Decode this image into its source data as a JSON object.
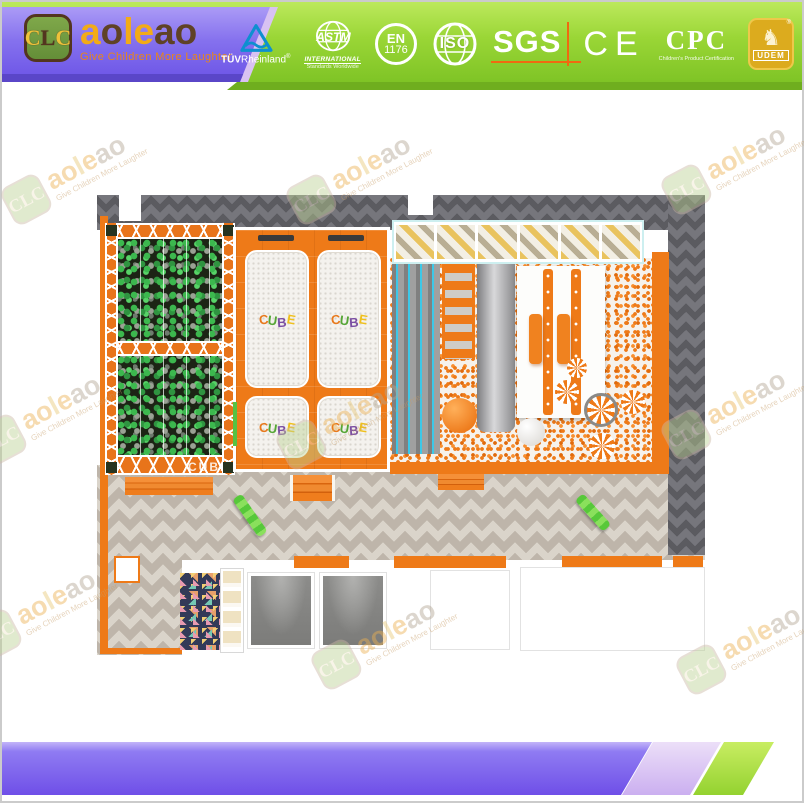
{
  "header": {
    "badge_letters": {
      "left": "C",
      "mid": "L",
      "right": "C"
    },
    "brand": "aoleao",
    "brand_letters": [
      {
        "ch": "a",
        "color": "#f2ab18"
      },
      {
        "ch": "o",
        "color": "#5f4226"
      },
      {
        "ch": "l",
        "color": "#f2ab18"
      },
      {
        "ch": "e",
        "color": "#f2ab18"
      },
      {
        "ch": "a",
        "color": "#5f4226"
      },
      {
        "ch": "o",
        "color": "#5f4226"
      }
    ],
    "tagline": "Give Children More Laughter",
    "certifications": [
      {
        "id": "tuv",
        "line1": "TÜV",
        "line2": "Rheinland",
        "reg": "®"
      },
      {
        "id": "astm",
        "word": "ASTM",
        "sub1": "INTERNATIONAL",
        "sub2": "Standards Worldwide"
      },
      {
        "id": "en",
        "line1": "EN",
        "line2": "1176"
      },
      {
        "id": "iso",
        "label": "ISO"
      },
      {
        "id": "sgs",
        "label": "SGS"
      },
      {
        "id": "ce",
        "label": "CE"
      },
      {
        "id": "cpc",
        "label": "CPC",
        "sub": "Children's Product Certification"
      },
      {
        "id": "udem",
        "label": "UDEM",
        "reg": "®"
      }
    ]
  },
  "watermark": {
    "badge": "CLC",
    "brand": "aoleao",
    "tagline": "Give Children More Laughter",
    "brand_letters": [
      {
        "ch": "a",
        "color": "#edb152"
      },
      {
        "ch": "o",
        "color": "#edb152"
      },
      {
        "ch": "l",
        "color": "#e8c878"
      },
      {
        "ch": "e",
        "color": "#edb152"
      },
      {
        "ch": "a",
        "color": "#b3a693"
      },
      {
        "ch": "o",
        "color": "#b3a693"
      }
    ],
    "positions": [
      [
        85,
        185
      ],
      [
        370,
        185
      ],
      [
        745,
        175
      ],
      [
        60,
        425
      ],
      [
        360,
        430
      ],
      [
        745,
        420
      ],
      [
        55,
        620
      ],
      [
        395,
        650
      ],
      [
        760,
        655
      ]
    ]
  },
  "playground": {
    "cube_logo_letters": [
      {
        "ch": "C",
        "color": "#e8791c"
      },
      {
        "ch": "U",
        "color": "#55a636"
      },
      {
        "ch": "B",
        "color": "#7b4fa2"
      },
      {
        "ch": "E",
        "color": "#efc01d"
      }
    ],
    "foam_pit_label": "CUBE"
  },
  "colors": {
    "header_purple": "#7b63ea",
    "header_green": "#9ad636",
    "accent_orange": "#ee7a18",
    "band_purple": "#8468ee",
    "band_lilac": "#d7c3f2",
    "band_green": "#9ad83e",
    "foam_green": "#3cb84e",
    "floor_dark": "#5b5b60",
    "floor_light": "#beb5aa"
  }
}
